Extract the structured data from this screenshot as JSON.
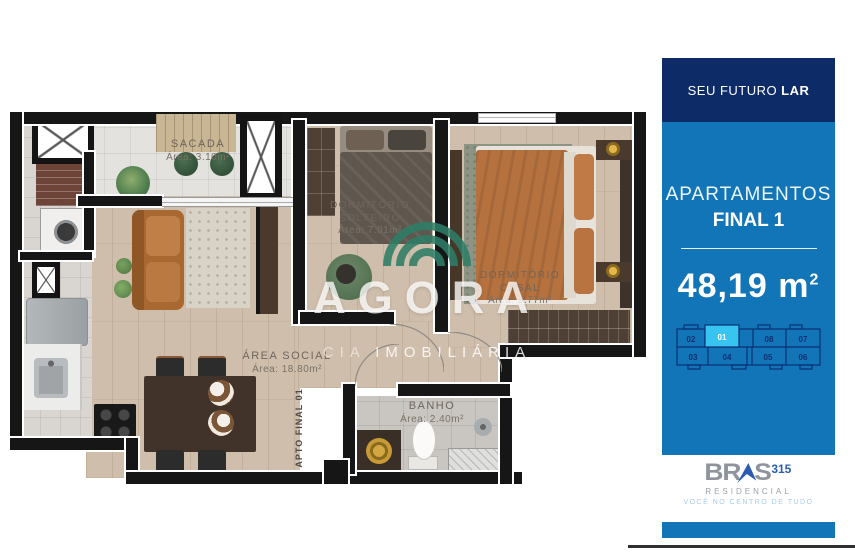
{
  "plan": {
    "watermark": {
      "brand": "AGORA",
      "company_prefix": "CIA",
      "company": "IMOBILIÁRIA"
    },
    "unit_label": "APTO FINAL 01",
    "rooms": {
      "sacada": {
        "name": "SACADA",
        "area": "Área: 3.10m²"
      },
      "solteiro": {
        "name": "DORMITÓRIO SOLTEIRO",
        "area": "Área: 7.01m²"
      },
      "casal": {
        "name": "DORMITÓRIO CASAL",
        "area": "Área: 9.77m²"
      },
      "social": {
        "name": "ÁREA SOCIAL",
        "area": "Área: 18.80m²"
      },
      "banho": {
        "name": "BANHO",
        "area": "Área: 2.40m²"
      }
    }
  },
  "sidebar": {
    "header_regular": "SEU FUTURO",
    "header_bold": "LAR",
    "title": "APARTAMENTOS",
    "subtitle": "FINAL 1",
    "area": {
      "value": "48,19",
      "unit": "m",
      "sup": "2"
    },
    "floorplate": {
      "selected": "01",
      "units_top": [
        "02",
        "01",
        "08",
        "07"
      ],
      "units_bottom": [
        "03",
        "04",
        "05",
        "06"
      ]
    },
    "logo": {
      "brand_left": "BR",
      "brand_right": "S",
      "number": "315",
      "division": "RESIDENCIAL",
      "tagline": "VOCÊ NO CENTRO DE TUDO"
    }
  },
  "colors": {
    "navy": "#0d2b66",
    "blue": "#1175b7",
    "unit_highlight": "#38c4f0",
    "plate_outline": "#0d2f72",
    "watermark_green": "#2e7d66",
    "logo_gray": "#8e939c",
    "logo_blue": "#2b5cb0"
  }
}
